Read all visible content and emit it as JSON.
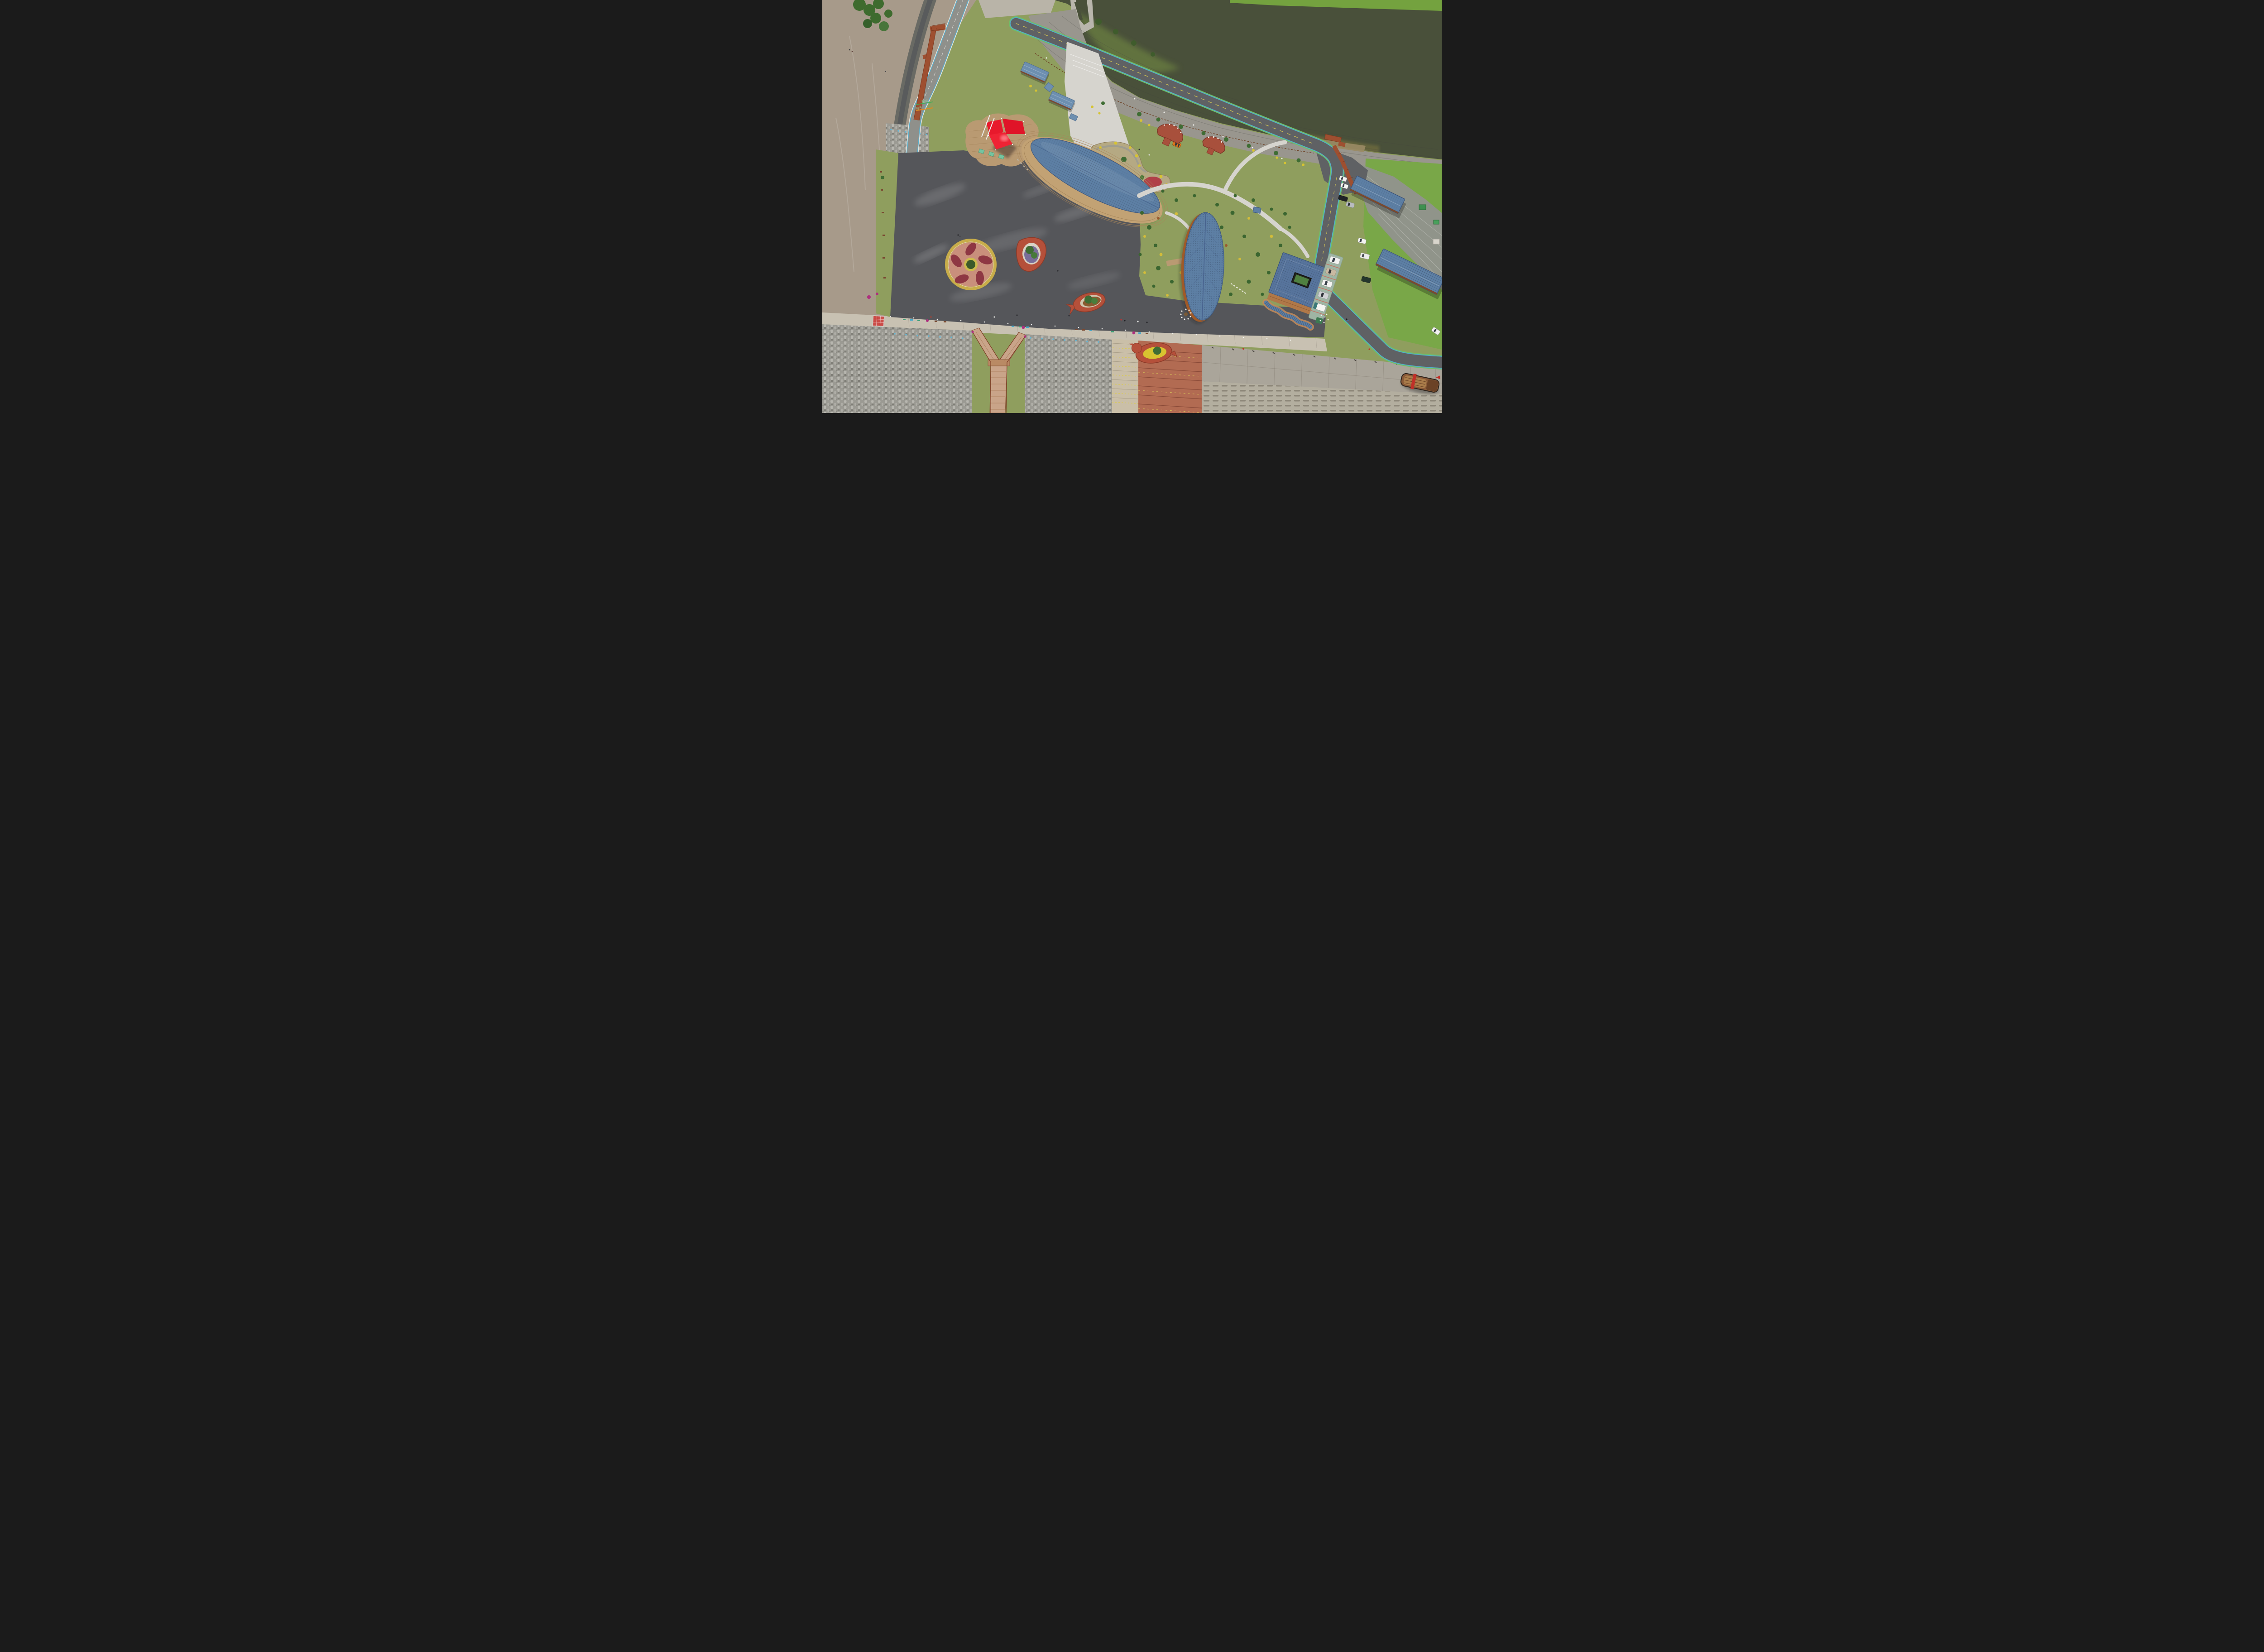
{
  "scene": {
    "title": "Aerial drone view of a coastal seaside park",
    "road_markings": {
      "start_label": "起点",
      "ride_label": "骑行"
    },
    "palette": {
      "pond_water": "#49503a",
      "pond_algae": "#66793f",
      "pond_shallow": "#6d6a3e",
      "mudflat": "#a79a8a",
      "wet_channel": "#5f6163",
      "grass": "#8f9e5e",
      "grass_bright": "#79a748",
      "grass_dry": "#a8a578",
      "plaza_asphalt": "#55565a",
      "road_asphalt": "#5f6164",
      "path_concrete": "#d6d4ce",
      "leaf_roof_blue": "#5d7fa4",
      "roof_edge_blue": "#42597c",
      "deck_wood": "#c2a274",
      "boardwalk_red": "#9e4f30",
      "tent_red": "#e8192c",
      "viewing_deck_brick": "#a8503c",
      "terrace_red": "#b26b52",
      "seawall_concrete": "#c8c1b2",
      "tetrapod_grey": "#9b9a93",
      "tetrapod_blue_top": "#63b7d6",
      "revetment": "#aaa59a",
      "flower_yellow": "#d6c332",
      "flower_magenta": "#ae2f7e",
      "flowerbed_pink": "#c98f7c",
      "flowerbed_petal": "#8e3743",
      "lane_green": "#6fbe67",
      "lane_cyan": "#54aecb",
      "lane_yellow": "#d9ca51",
      "boat_hull": "#8a5a38",
      "boat_band": "#c03028",
      "parking_pavement": "#9fb5a4",
      "courtyard_green": "#4f8040"
    },
    "inventory": {
      "leaf_roof_pavilions": 2,
      "courtyard_building": 1,
      "roadside_cabins": 2,
      "red_sail_canopy": 1,
      "blue_road_shelters": 4,
      "red_viewing_decks": 2,
      "parking_cars": 4,
      "parking_truck": 1,
      "roadside_parked_cars": 7,
      "moving_car_colors": [
        "white",
        "orange"
      ],
      "planter_islands": 3,
      "circular_flower_bed": 1,
      "beached_boat": 1,
      "y_stairway": 1,
      "pond_sluice": 1
    }
  }
}
